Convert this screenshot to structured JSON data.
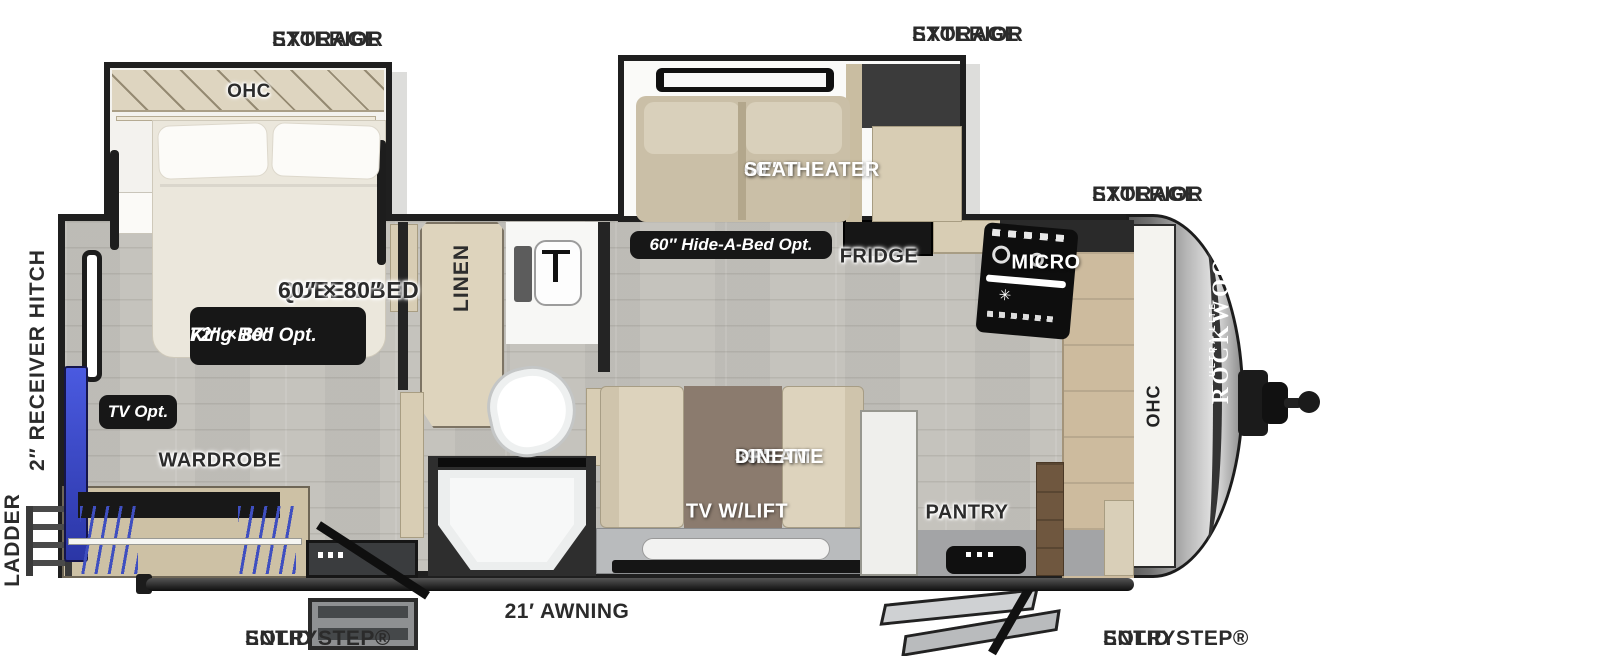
{
  "brand": {
    "name": "ROCKWOOD",
    "tagline": "ULTRA LITE"
  },
  "labels": {
    "storage_rear_l1": "EXTERIOR",
    "storage_rear_l2": "STORAGE",
    "storage_mid_l1": "EXTERIOR",
    "storage_mid_l2": "STORAGE",
    "storage_front_l1": "EXTERIOR",
    "storage_front_l2": "STORAGE",
    "receiver_hitch": "2″ RECEIVER HITCH",
    "ladder": "LADDER",
    "ohc_bedroom": "OHC",
    "queen_l1": "QUEEN BED",
    "queen_l2": "60″ × 80″",
    "king_l1": "72″ × 80″",
    "king_l2": "King Bed Opt.",
    "tv_opt": "TV Opt.",
    "wardrobe": "WARDROBE",
    "linen": "LINEN",
    "theater_l1": "60″ THEATER",
    "theater_l2": "SEAT",
    "hide_a_bed": "60″ Hide-A-Bed Opt.",
    "fridge": "FRIDGE",
    "micro": "MICRO",
    "dinette_l1": "39″",
    "dinette_l2": "DREAM",
    "dinette_l3": "DINETTE",
    "tv_lift": "TV W/LIFT",
    "pantry": "PANTRY",
    "ohc_front": "OHC",
    "entry_left_l1": "SOLID STEP®",
    "entry_left_l2": "ENTRY",
    "awning": "21′ AWNING",
    "entry_right_l1": "SOLID STEP®",
    "entry_right_l2": "ENTRY"
  },
  "colors": {
    "wall": "#1f1f1f",
    "floor": "#c5c3bd",
    "badge": "#171717",
    "accent_blue": "#4050c8",
    "wood": "#d8cdb4",
    "cap_silver": "#b7b7b7"
  }
}
